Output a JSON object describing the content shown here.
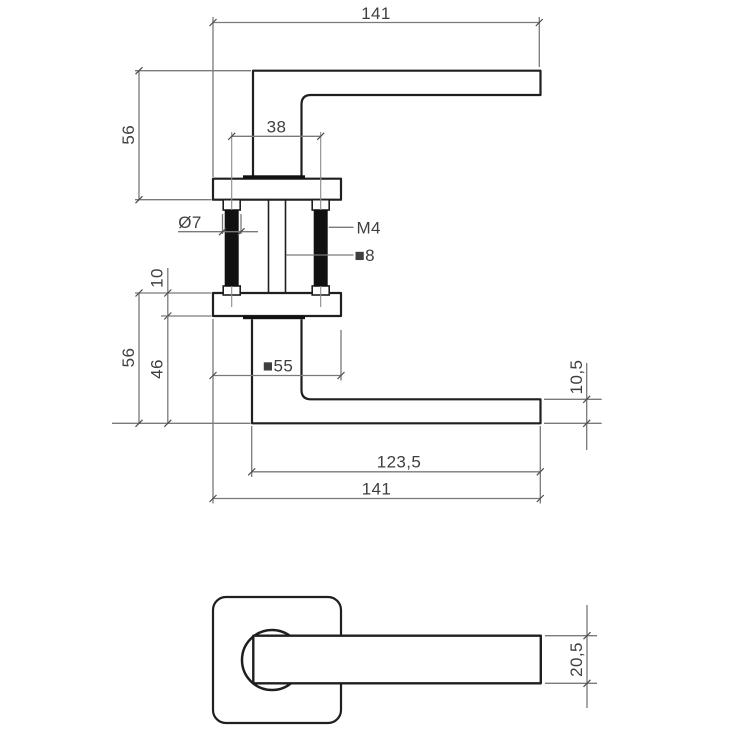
{
  "drawing": {
    "kind": "door-handle dimensional drawing",
    "views": {
      "top_view": {
        "total_length": "141",
        "height": "56",
        "screw_spacing": "38"
      },
      "section": {
        "screw_diameter": "Ø7",
        "thread_size": "M4",
        "spindle_size": "■8",
        "rosette_thickness": "10"
      },
      "side_view": {
        "height": "56",
        "neck_height": "46",
        "rosette_width": "■55",
        "grip_length": "123,5",
        "total_length": "141",
        "grip_thickness": "10,5"
      },
      "front_view": {
        "grip_width": "20,5"
      }
    },
    "colors": {
      "object_line": "#1f1f1f",
      "dimension_line": "#7a7a7a",
      "dimension_text": "#3f3f3f",
      "solid_fill": "#111111",
      "background": "#ffffff"
    }
  }
}
